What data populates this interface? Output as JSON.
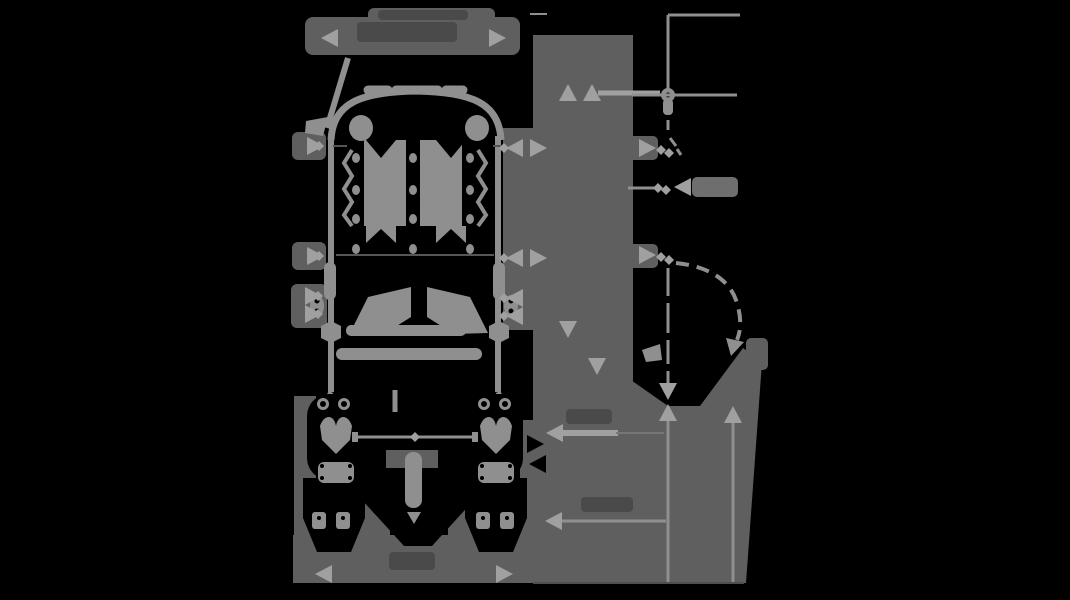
{
  "image": {
    "description": "Dimensional technical line drawing of a child stroller seat on a black (transparent) background: front view on the left, side view on the right, annotated with gray dimension lines, arrowheads and dark illegible measurement labels",
    "width": 1070,
    "height": 600
  },
  "colors": {
    "background": "#000000",
    "line": "#8f8f8f",
    "arrow": "#a0a0a0",
    "halo": "#5f5f5f",
    "halo_light": "#6e6e6e",
    "halo_dark": "#4a4a4a",
    "ink": "#000000"
  },
  "views": [
    {
      "id": "front-view",
      "label": "front view"
    },
    {
      "id": "side-view",
      "label": "side view"
    }
  ],
  "annotations": {
    "arrow_size": {
      "length": 17,
      "half_width": 9
    },
    "arrows": [
      {
        "x": 321,
        "y": 38,
        "dir": "left"
      },
      {
        "x": 506,
        "y": 38,
        "dir": "right"
      },
      {
        "x": 315,
        "y": 574,
        "dir": "left"
      },
      {
        "x": 513,
        "y": 574,
        "dir": "right"
      },
      {
        "x": 324,
        "y": 146,
        "dir": "right"
      },
      {
        "x": 324,
        "y": 256,
        "dir": "right"
      },
      {
        "x": 322,
        "y": 296,
        "dir": "right"
      },
      {
        "x": 322,
        "y": 314,
        "dir": "right"
      },
      {
        "x": 506,
        "y": 148,
        "dir": "left"
      },
      {
        "x": 506,
        "y": 258,
        "dir": "left"
      },
      {
        "x": 506,
        "y": 298,
        "dir": "left"
      },
      {
        "x": 506,
        "y": 316,
        "dir": "left"
      },
      {
        "x": 547,
        "y": 148,
        "dir": "right"
      },
      {
        "x": 547,
        "y": 258,
        "dir": "right"
      },
      {
        "x": 568,
        "y": 84,
        "dir": "up"
      },
      {
        "x": 592,
        "y": 84,
        "dir": "up"
      },
      {
        "x": 568,
        "y": 338,
        "dir": "down"
      },
      {
        "x": 597,
        "y": 375,
        "dir": "down"
      },
      {
        "x": 656,
        "y": 148,
        "dir": "right"
      },
      {
        "x": 656,
        "y": 255,
        "dir": "right"
      },
      {
        "x": 674,
        "y": 187,
        "dir": "left"
      },
      {
        "x": 668,
        "y": 400,
        "dir": "down"
      },
      {
        "x": 668,
        "y": 404,
        "dir": "up"
      },
      {
        "x": 733,
        "y": 406,
        "dir": "up"
      },
      {
        "x": 546,
        "y": 433,
        "dir": "left"
      },
      {
        "x": 545,
        "y": 521,
        "dir": "left"
      }
    ],
    "cutout_arrows": [
      {
        "x": 544,
        "y": 444,
        "dir": "right"
      },
      {
        "x": 529,
        "y": 464,
        "dir": "left"
      }
    ],
    "tick_diamonds": [
      {
        "x": 319,
        "y": 146
      },
      {
        "x": 319,
        "y": 256
      },
      {
        "x": 318,
        "y": 296
      },
      {
        "x": 318,
        "y": 314
      },
      {
        "x": 504,
        "y": 148
      },
      {
        "x": 504,
        "y": 258
      },
      {
        "x": 504,
        "y": 298
      },
      {
        "x": 504,
        "y": 316
      },
      {
        "x": 661,
        "y": 150
      },
      {
        "x": 669,
        "y": 153
      },
      {
        "x": 661,
        "y": 257
      },
      {
        "x": 669,
        "y": 260
      },
      {
        "x": 658,
        "y": 188
      },
      {
        "x": 666,
        "y": 190
      },
      {
        "x": 415,
        "y": 437
      }
    ],
    "label_smudges": [
      {
        "x": 357,
        "y": 22,
        "w": 100,
        "h": 20
      },
      {
        "x": 378,
        "y": 10,
        "w": 90,
        "h": 10
      },
      {
        "x": 389,
        "y": 552,
        "w": 46,
        "h": 18
      },
      {
        "x": 566,
        "y": 409,
        "w": 46,
        "h": 15
      },
      {
        "x": 581,
        "y": 497,
        "w": 52,
        "h": 15
      }
    ]
  }
}
